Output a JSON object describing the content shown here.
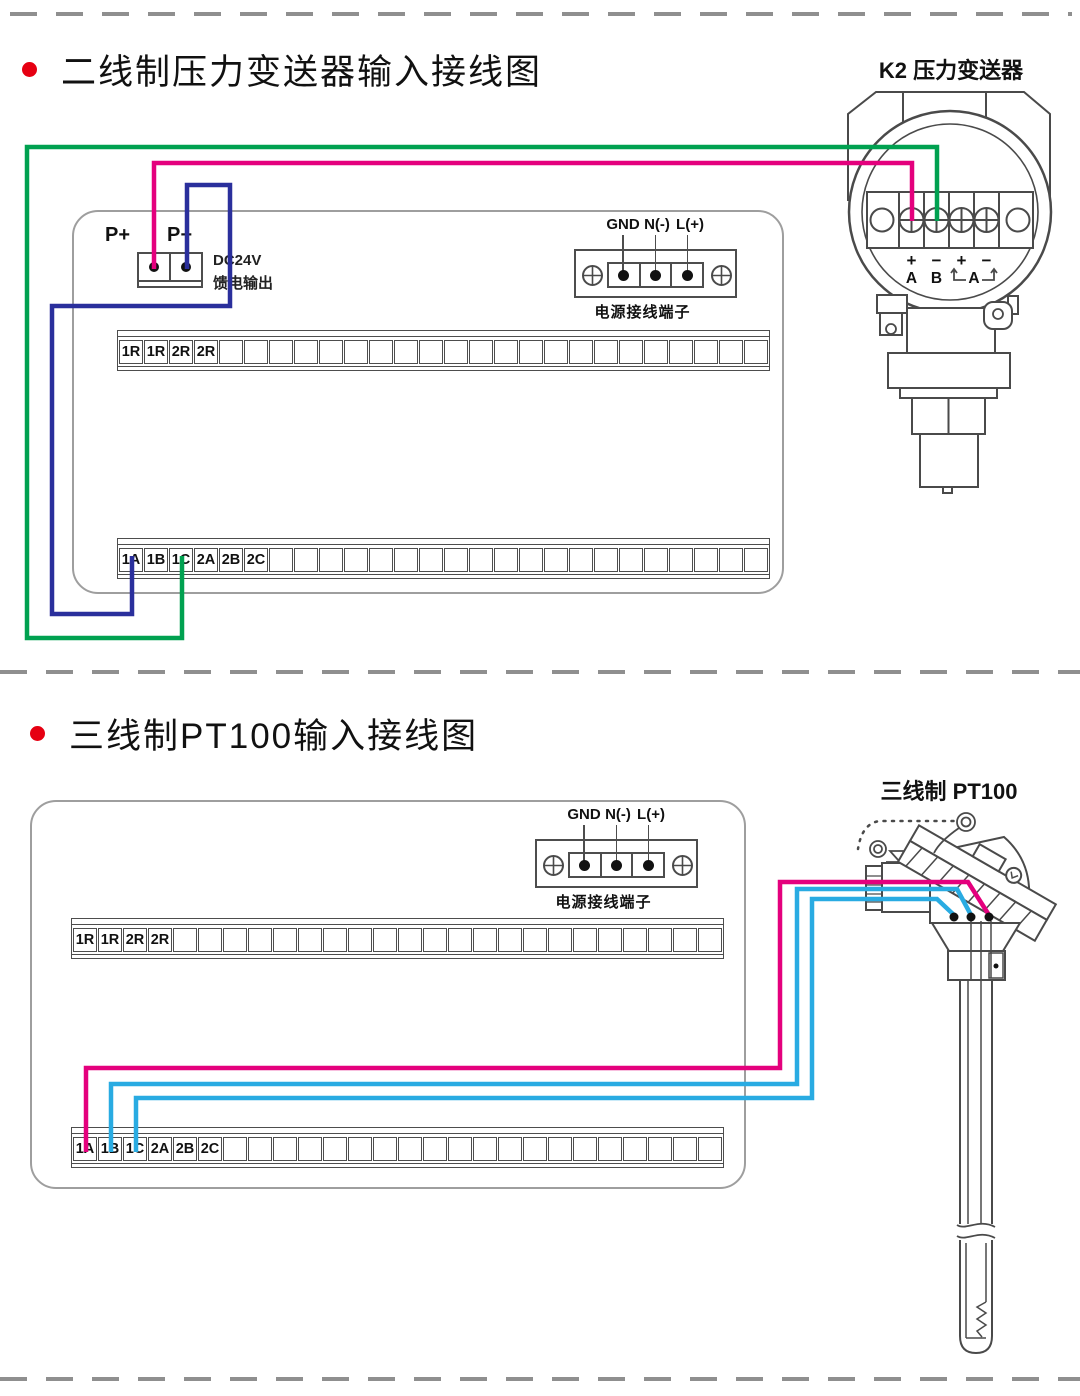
{
  "colors": {
    "magenta": "#E4007D",
    "green": "#00A150",
    "blue": "#2A2F9C",
    "cyan": "#29ABE2",
    "outline": "#4a4a4a",
    "bullet": "#E60012"
  },
  "section1": {
    "title": "二线制压力变送器输入接线图",
    "device_title": "K2  压力变送器",
    "pp": {
      "plus": "P+",
      "minus": "P−",
      "dc_line1": "DC24V",
      "dc_line2": "馈电输出"
    },
    "power": {
      "labels": [
        "GND",
        "N(-)",
        "L(+)"
      ],
      "caption": "电源接线端子"
    },
    "strip_r": {
      "labels": [
        "1R",
        "1R",
        "2R",
        "2R"
      ],
      "cells": 26
    },
    "strip_a": {
      "labels": [
        "1A",
        "1B",
        "1C",
        "2A",
        "2B",
        "2C"
      ],
      "cells": 26
    },
    "transmitter": {
      "signs": [
        "+",
        "−",
        "+",
        "−"
      ],
      "letters": [
        "A",
        "B"
      ],
      "bracket_letter": "A"
    }
  },
  "section2": {
    "title": "三线制PT100输入接线图",
    "device_title": "三线制  PT100",
    "power": {
      "labels": [
        "GND",
        "N(-)",
        "L(+)"
      ],
      "caption": "电源接线端子"
    },
    "strip_r": {
      "labels": [
        "1R",
        "1R",
        "2R",
        "2R"
      ],
      "cells": 26
    },
    "strip_a": {
      "labels": [
        "1A",
        "1B",
        "1C",
        "2A",
        "2B",
        "2C"
      ],
      "cells": 26
    }
  },
  "wires": {
    "stroke_width": 4.5,
    "paths": [
      {
        "name": "wire-p-plus-to-transmitter-A",
        "color": "magenta",
        "points": [
          [
            154,
            269
          ],
          [
            154,
            163
          ],
          [
            912,
            163
          ],
          [
            912,
            221
          ]
        ]
      },
      {
        "name": "wire-1C-to-transmitter-B",
        "color": "green",
        "points": [
          [
            182,
            556
          ],
          [
            182,
            638
          ],
          [
            27,
            638
          ],
          [
            27,
            147
          ],
          [
            937,
            147
          ],
          [
            937,
            221
          ]
        ]
      },
      {
        "name": "wire-p-minus-to-1A",
        "color": "blue",
        "points": [
          [
            187,
            269
          ],
          [
            187,
            185
          ],
          [
            230,
            185
          ],
          [
            230,
            306
          ],
          [
            52,
            306
          ],
          [
            52,
            614
          ],
          [
            132,
            614
          ],
          [
            132,
            556
          ]
        ]
      },
      {
        "name": "wire-1A-to-pt100-right",
        "color": "magenta",
        "points": [
          [
            86,
            1152
          ],
          [
            86,
            1068
          ],
          [
            780,
            1068
          ],
          [
            780,
            882
          ],
          [
            968,
            882
          ],
          [
            989,
            915
          ]
        ]
      },
      {
        "name": "wire-1B-to-pt100-middle",
        "color": "cyan",
        "points": [
          [
            111,
            1152
          ],
          [
            111,
            1084
          ],
          [
            797,
            1084
          ],
          [
            797,
            889
          ],
          [
            957,
            889
          ],
          [
            971,
            915
          ]
        ]
      },
      {
        "name": "wire-1C-to-pt100-left",
        "color": "cyan",
        "points": [
          [
            136,
            1152
          ],
          [
            136,
            1098
          ],
          [
            812,
            1098
          ],
          [
            812,
            899
          ],
          [
            937,
            899
          ],
          [
            954,
            915
          ]
        ]
      }
    ],
    "terminal_dots": [
      [
        954,
        917
      ],
      [
        971,
        917
      ],
      [
        989,
        917
      ]
    ]
  }
}
